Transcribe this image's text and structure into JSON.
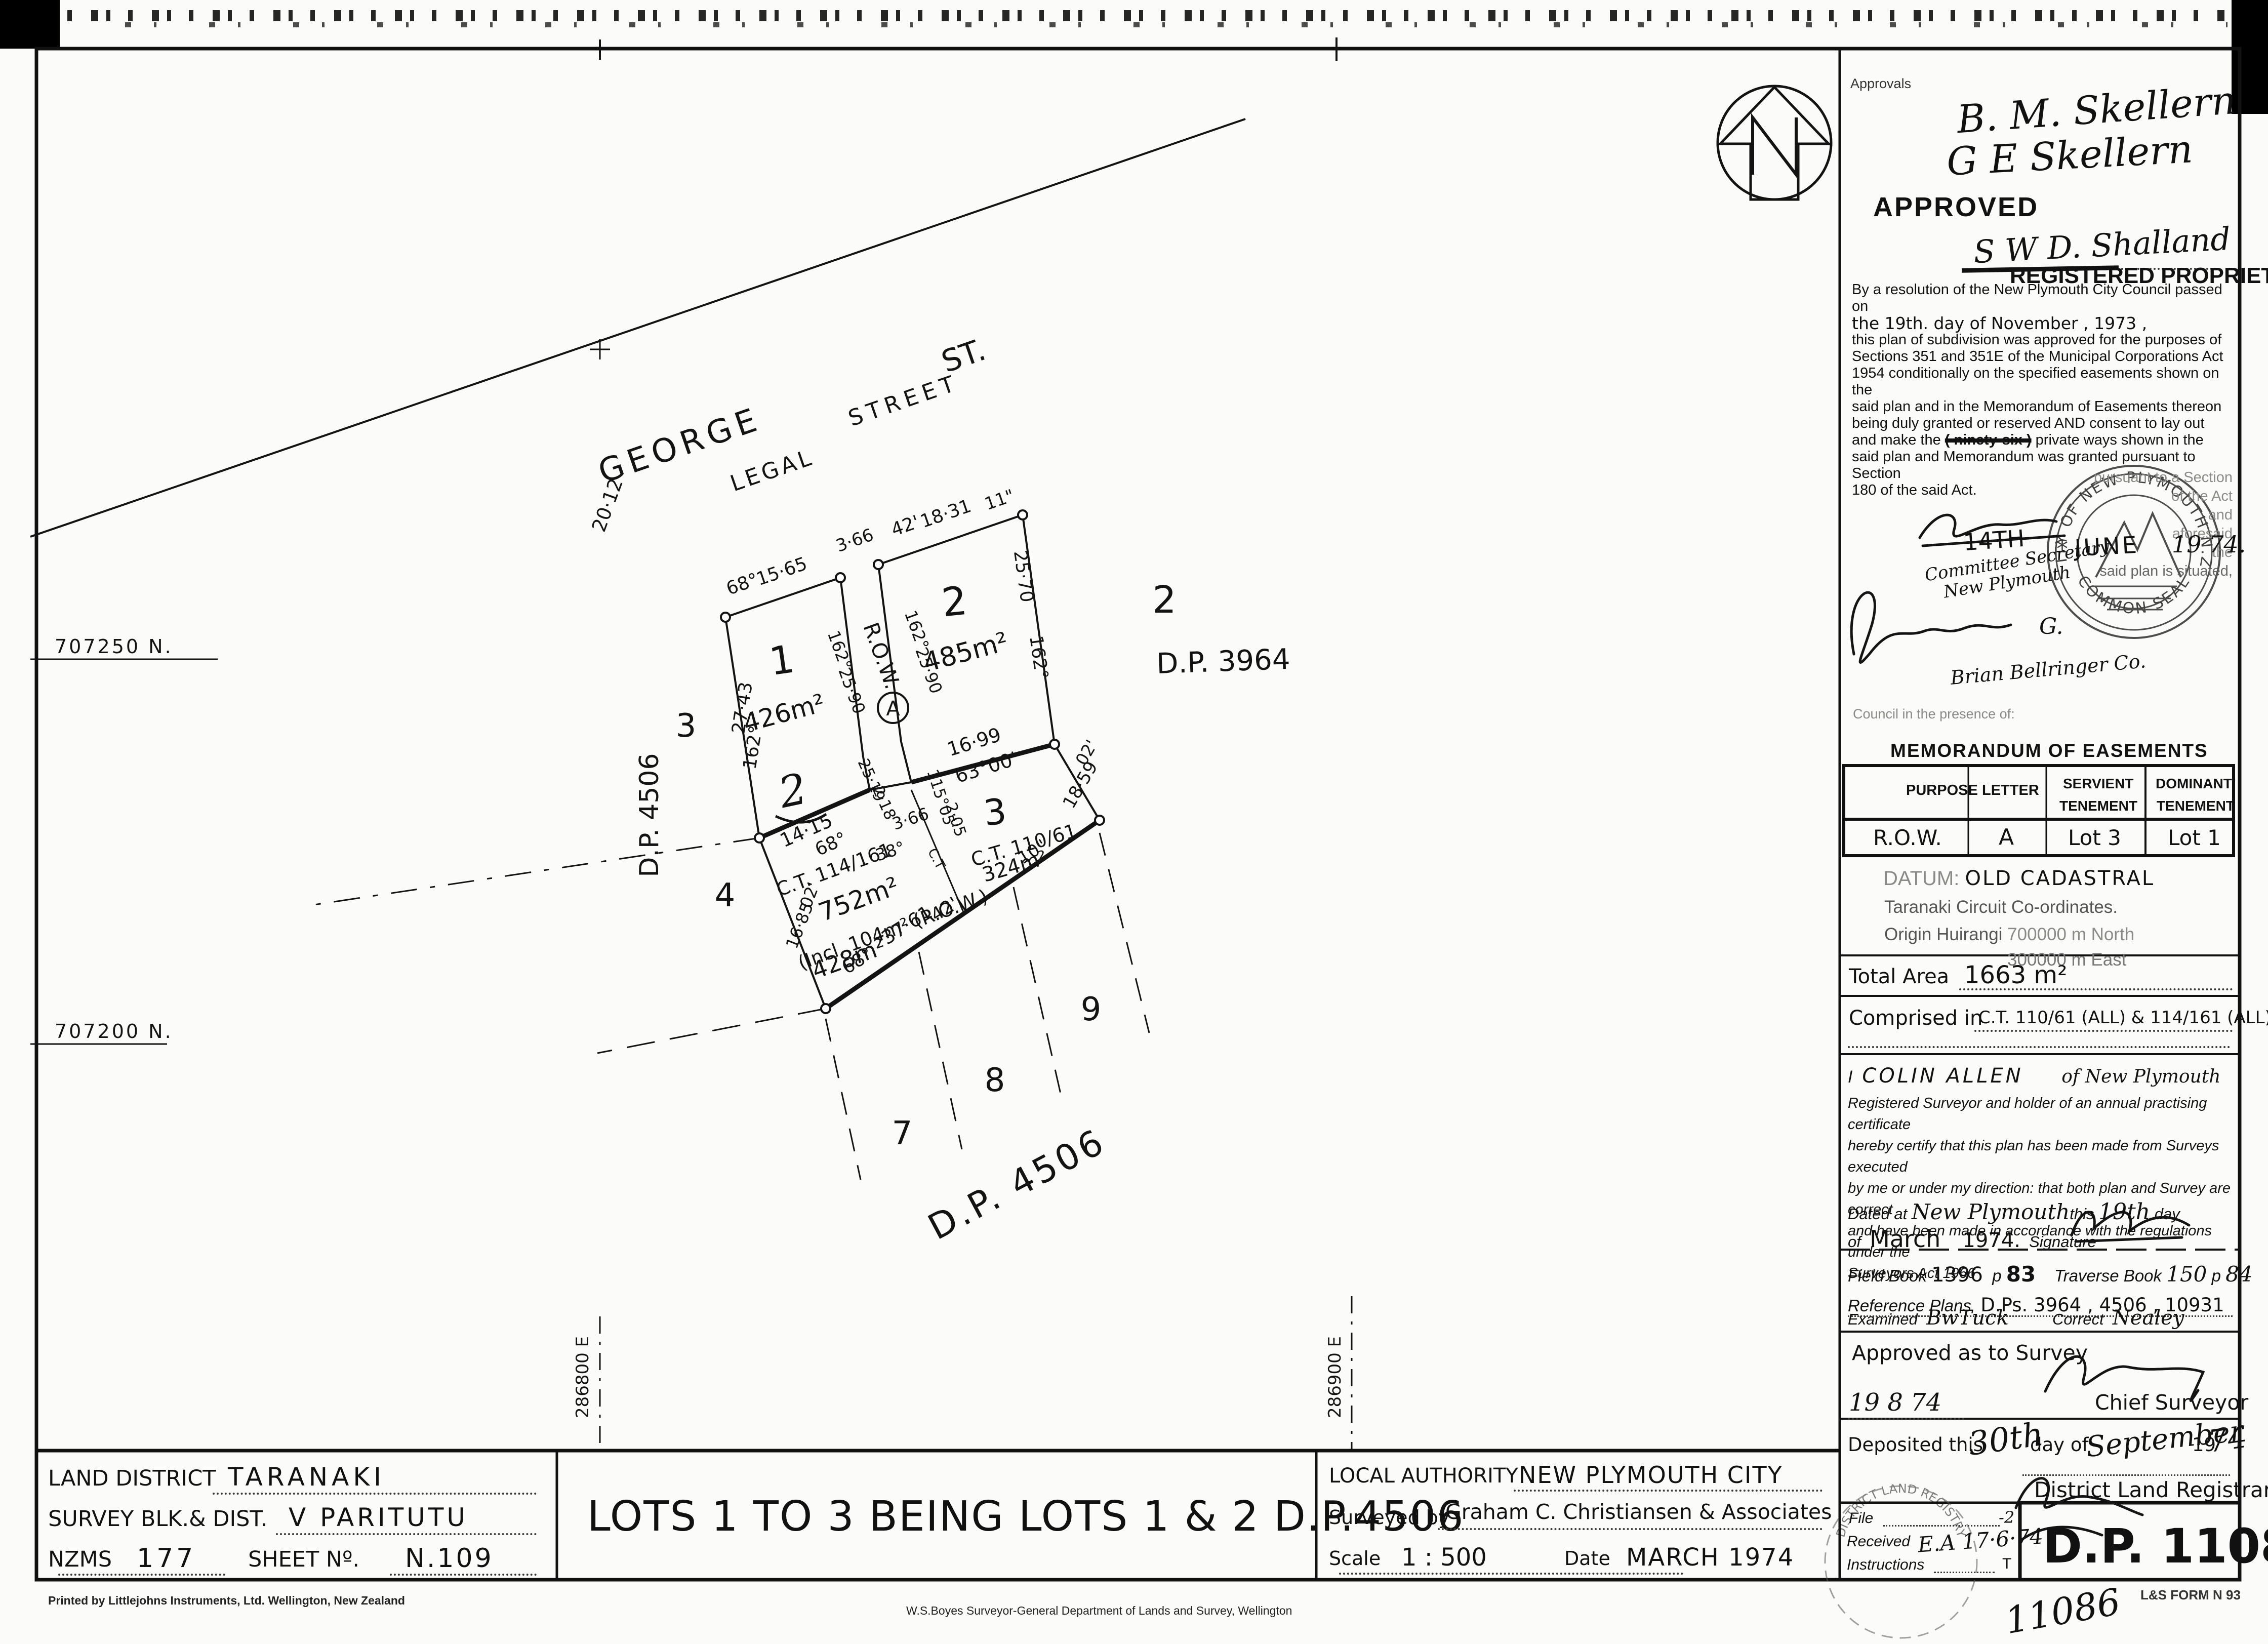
{
  "plan": {
    "street": {
      "george": "GEORGE",
      "legal": "LEGAL",
      "street": "STREET",
      "st": "ST.",
      "width": "20·12"
    },
    "front": {
      "b68": "68°",
      "d1565": "15·65",
      "row_w": "3·66",
      "b42": "42'",
      "d1831": "18·31",
      "sec11": "11\""
    },
    "lot1": {
      "num": "1",
      "area": "426m²",
      "hand2": "2",
      "wb": "27·43",
      "wdeg": "162°"
    },
    "row": {
      "label": "R.O.W.",
      "ldeg": "162°",
      "ld": "25·90",
      "rdeg": "162°",
      "rd": "25·90",
      "letter": "A",
      "bw": "3·66",
      "bb": "38°",
      "j2518": "25·19",
      "j218": "2·18",
      "j115": "115°05'",
      "j205": "2·05"
    },
    "lot2": {
      "num": "2",
      "area": "485m²",
      "ed": "25·70",
      "edeg": "162°"
    },
    "mid": {
      "d": "16·99",
      "b": "63°00'"
    },
    "lot3": {
      "num": "3",
      "ct": "C.T. 110/61",
      "area": "324m²",
      "emin": "02'",
      "ed": "18·59"
    },
    "l752": {
      "ct": "C.T. 114/161",
      "area": "752m²",
      "incl": "(Incl. 104m² (R.O.W.)",
      "area2": "428m²",
      "wmin": "02'",
      "wd": "16·85"
    },
    "bot": {
      "b68": "68°",
      "d": "37·61",
      "b42": "42'",
      "sec10": "10\""
    },
    "h1415": {
      "d": "14·15",
      "b": "68°"
    },
    "ctdiv": "C.T",
    "adj": {
      "a3": "3",
      "a4": "4",
      "a7": "7",
      "a8": "8",
      "a9": "9",
      "dpv": "D.P. 4506",
      "dpd": "D.P. 4506",
      "dp3964num": "2",
      "dp3964": "D.P. 3964"
    },
    "coords": {
      "n1": "707250 N.",
      "n2": "707200 N.",
      "e1": "286800 E",
      "e2": "286900 E"
    },
    "north": "N"
  },
  "ap": {
    "label": "Approvals",
    "sig1": "B. M. Skellern",
    "sig2": "G E Skellern",
    "approved": "APPROVED",
    "sig3": "S W D. Shalland",
    "registered": "REGISTERED PROPRIETOR",
    "r": {
      "l1": "By a resolution of the New Plymouth City Council passed on",
      "l2": "the      19th.      day of      November      , 1973 ,",
      "l3": "this plan of subdivision was approved for the purposes of",
      "l4": "Sections 351 and 351E of the Municipal Corporations Act",
      "l5": "1954 conditionally on the specified easements shown on the",
      "l6": "said plan and in the Memorandum of Easements thereon",
      "l7": "being duly granted or reserved AND consent to lay out",
      "l8a": "and make the ",
      "l8b": "( ninety-six )",
      "l8c": " private ways shown in the",
      "l9": "said plan and Memorandum was granted pursuant to Section",
      "l10": "180 of the said Act."
    },
    "f": {
      "f1": "pursuant to a Section",
      "f2": "of the Act",
      "f3": "and",
      "f4": "aforesaid",
      "f5": "the",
      "f6": "said plan is situated,",
      "presence": "Council in the presence of:"
    },
    "date": {
      "d": "14TH",
      "m": "JUNE",
      "y": "19 74."
    },
    "seal": {
      "top": "CITY OF NEW PLYMOUTH N.Z.",
      "bottom": "COMMON SEAL",
      "star": "*"
    },
    "committee1": "Committee Secretary",
    "committee2": "New Plymouth",
    "edgar_g": "G.",
    "brian": "Brian Bellringer Co."
  },
  "memo": {
    "title": "MEMORANDUM OF EASEMENTS",
    "h1": "PURPOSE",
    "h2": "LETTER",
    "h3a": "SERVIENT",
    "h3b": "TENEMENT",
    "h4a": "DOMINANT",
    "h4b": "TENEMENT",
    "row": {
      "r1": "R.O.W.",
      "r2": "A",
      "r3": "Lot 3",
      "r4": "Lot 1"
    }
  },
  "datum": {
    "l1a": "DATUM:",
    "l1b": "OLD CADASTRAL",
    "l2": "Taranaki Circuit Co-ordinates.",
    "l3a": "Origin Huirangi",
    "l3b": "700000 m  North",
    "l4": "300000 m  East"
  },
  "tot": {
    "label": "Total Area",
    "value": "1663 m²"
  },
  "comp": {
    "label": "Comprised in",
    "value": "C.T. 110/61 (ALL) & 114/161 (ALL)"
  },
  "cert": {
    "i": "I",
    "name": "COLIN  ALLEN",
    "of": "of New Plymouth",
    "l1": "Registered Surveyor and holder of an annual practising certificate",
    "l2": "hereby certify that this plan has been made from Surveys executed",
    "l3": "by me or under my direction:  that both plan and Survey are correct",
    "l4": "and have been made in accordance with the regulations under the",
    "l5": "Surveyors Act 1966",
    "dp1": "Dated at",
    "place": "New Plymouth",
    "this": "this",
    "day": "19th",
    "daylbl": "day",
    "ofl": "of",
    "month": "March",
    "year": "1974.",
    "siglbl": "Signature"
  },
  "books": {
    "fbl": "Field Book",
    "fb": "1396",
    "pl1": "p",
    "p1": "83",
    "tbl": "Traverse Book",
    "tb": "150",
    "pl2": "p",
    "p2": "84",
    "refl": "Reference Plans",
    "ref": "D.Ps. 3964 , 4506 , 10931"
  },
  "exam": {
    "l": "Examined",
    "name": "BwTuck",
    "cl": "Correct",
    "cname": "Nealey"
  },
  "sas": {
    "title": "Approved as to Survey",
    "date": "19  8  74",
    "role": "Chief Surveyor"
  },
  "dep": {
    "pre": "Deposited this",
    "day": "30th",
    "mid": "day of",
    "month": "September",
    "y1": "19",
    "y2": "74",
    "role": "District Land Registrar"
  },
  "fb": {
    "file": "File",
    "received": "Received",
    "rval": "E.A  17·6·74",
    "instr": "Instructions",
    "m1": "-2",
    "m2": "T",
    "dp": "D.P. 11086"
  },
  "fr": {
    "hand": "11086",
    "form": "L&S FORM N 93"
  },
  "stamp": {
    "text": "DISTRICT LAND REGISTRY"
  },
  "tb": {
    "ldl": "LAND DISTRICT",
    "ld": "TARANAKI",
    "svl": "SURVEY BLK.& DIST.",
    "sv": "V    PARITUTU",
    "nzl": "NZMS",
    "nz": "177",
    "shl": "SHEET Nº.",
    "sh": "N.109",
    "title": "LOTS 1 TO 3 BEING LOTS 1 & 2 D.P.4506",
    "lal": "LOCAL AUTHORITY",
    "la": "NEW PLYMOUTH CITY",
    "sbl": "Surveyed by",
    "sb": "Graham C. Christiansen & Associates",
    "scl": "Scale",
    "sc": "1 : 500",
    "dtl": "Date",
    "dt": "MARCH 1974",
    "printer": "Printed by Littlejohns Instruments, Ltd. Wellington, New Zealand",
    "sg": "W.S.Boyes   Surveyor-General   Department of Lands and Survey, Wellington"
  }
}
